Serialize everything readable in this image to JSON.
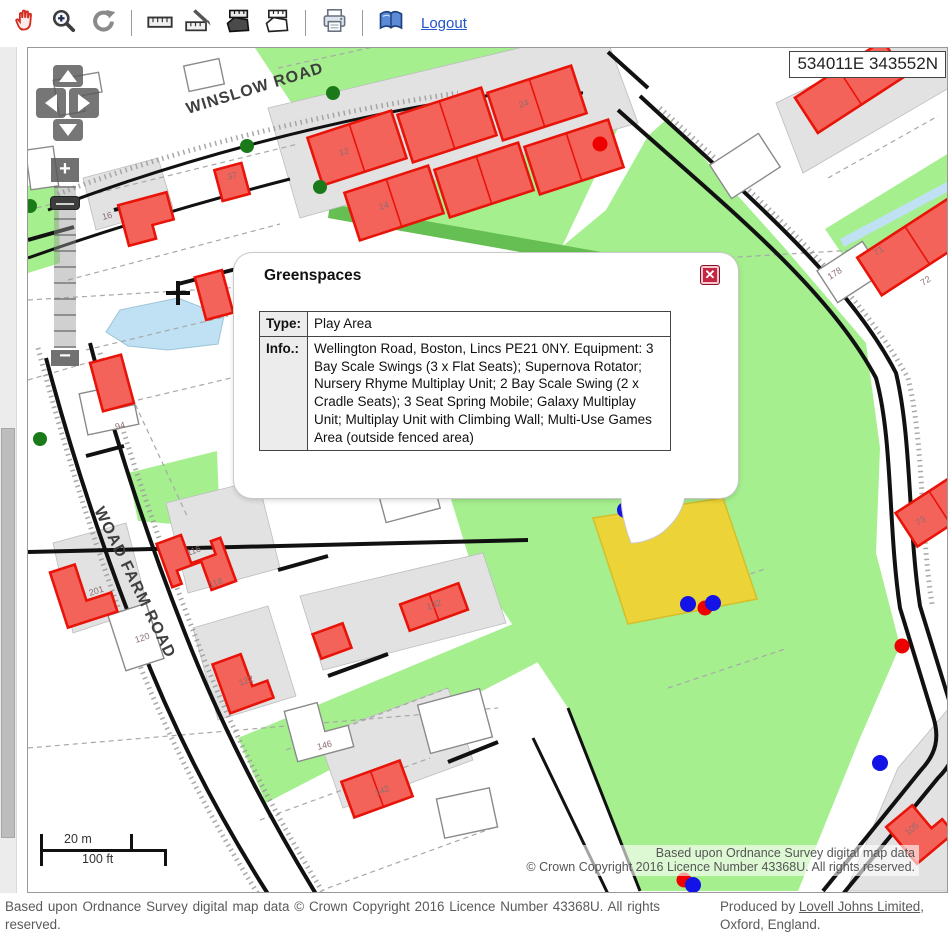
{
  "toolbar": {
    "logout_label": "Logout",
    "icons": [
      "pan-hand-icon",
      "zoom-in-icon",
      "refresh-icon",
      "measure-line-icon",
      "measure-distance-icon",
      "measure-area-filled-icon",
      "measure-area-outline-icon",
      "print-icon",
      "legend-book-icon"
    ]
  },
  "map": {
    "coordinates_readout": "534011E 343552N",
    "road_labels": {
      "winslow": "WINSLOW ROAD",
      "woad_farm": "WOAD FARM ROAD"
    },
    "house_numbers": [
      "12",
      "24",
      "14",
      "16",
      "37",
      "94",
      "201",
      "116",
      "118",
      "120",
      "122",
      "132",
      "142",
      "146",
      "134",
      "71",
      "72",
      "73",
      "178",
      "105"
    ],
    "scale_bar": {
      "metric": "20 m",
      "imperial": "100 ft"
    },
    "attribution_line1": "Based upon Ordnance Survey digital map data",
    "attribution_line2": "© Crown Copyright 2016 Licence Number 43368U. All rights reserved.",
    "colors": {
      "greenspace": "#a5ef8e",
      "hedge": "#66bf52",
      "parcel_gray": "#e2e2e2",
      "building_red_fill": "#f4635a",
      "building_red_stroke": "#e81309",
      "water": "#bfe1f3",
      "selected_feature_yellow": "#ecd438",
      "point_blue": "#1313e8",
      "point_red": "#ee0000",
      "point_green": "#1a7a1a"
    }
  },
  "popup": {
    "title": "Greenspaces",
    "rows": [
      {
        "label": "Type:",
        "value": "Play Area"
      },
      {
        "label": "Info.:",
        "value": "Wellington Road, Boston, Lincs PE21 0NY. Equipment: 3 Bay Scale Swings (3 x Flat Seats); Supernova Rotator; Nursery Rhyme Multiplay Unit; 2 Bay Scale Swing (2 x Cradle Seats); 3 Seat Spring Mobile; Galaxy Multiplay Unit; Multiplay Unit with Climbing Wall; Multi-Use Games Area (outside fenced area)"
      }
    ],
    "close_label": "✕"
  },
  "footer": {
    "left": "Based upon Ordnance Survey digital map data © Crown Copyright 2016 Licence Number 43368U. All rights reserved.",
    "right_prefix": "Produced by ",
    "right_link": "Lovell Johns Limited",
    "right_suffix": ",",
    "right_line2": "Oxford, England."
  }
}
